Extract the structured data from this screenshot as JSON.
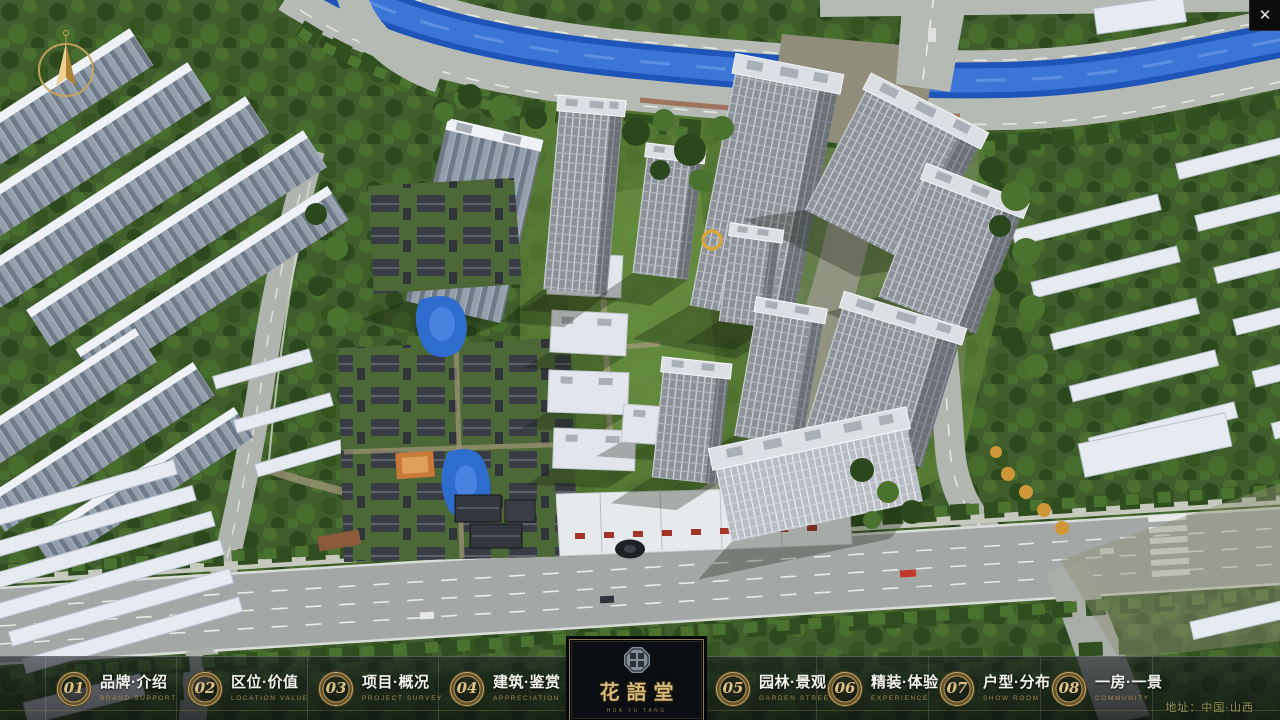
{
  "app": {
    "close_label": "✕",
    "address": "地址：中国·山西"
  },
  "logo": {
    "name_zh": "花語堂",
    "subtext": "HUA YU TANG"
  },
  "navbar": {
    "items": [
      {
        "num": "01",
        "zh": "品牌·介绍",
        "en": "BRAND SUPPORT"
      },
      {
        "num": "02",
        "zh": "区位·价值",
        "en": "LOCATION VALUE"
      },
      {
        "num": "03",
        "zh": "项目·概况",
        "en": "PROJECT SURVEY"
      },
      {
        "num": "04",
        "zh": "建筑·鉴赏",
        "en": "APPRECIATION"
      },
      {
        "num": "05",
        "zh": "园林·景观",
        "en": "GARDEN STREET"
      },
      {
        "num": "06",
        "zh": "精装·体验",
        "en": "EXPERIENCE"
      },
      {
        "num": "07",
        "zh": "户型·分布",
        "en": "SHOW ROOM"
      },
      {
        "num": "08",
        "zh": "一房·一景",
        "en": "COMMUNITY"
      }
    ]
  },
  "colors": {
    "gold": "#c7a766",
    "bar_bg": "rgba(12,16,20,0.65)",
    "river": "#2155b6",
    "tree_dark": "#2b481c",
    "tree_light": "#4a7330"
  }
}
